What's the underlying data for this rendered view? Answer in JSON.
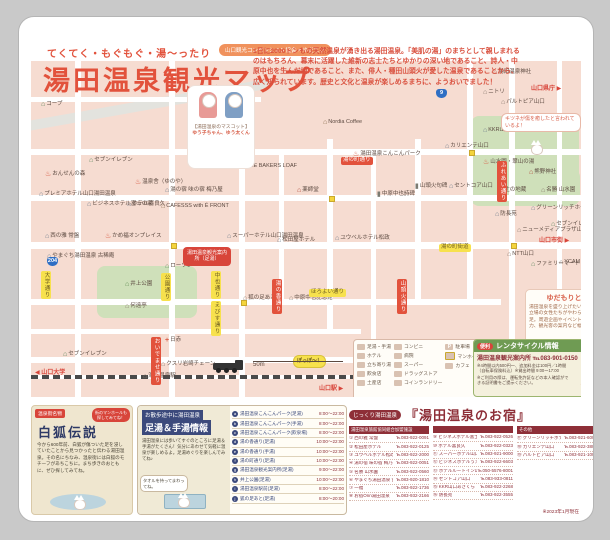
{
  "header": {
    "tagline": "てくてく・もぐもぐ・湯〜ったり",
    "title": "湯田温泉観光マップ",
    "assoc_badge": "山口観光コンベンション協会 × ゆだもり",
    "intro": "1日に2000トンもの天然温泉が湧き出る湯田温泉。「美肌の湯」のまちとして親しまれるのはもちろん、幕末に活躍した維新の志士たちとゆかりの深い地であること、詩人・中原中也を生んだ地であること、また、俳人・種田山頭火が愛した温泉であることから、広く知られています。歴史と文化と温泉が楽しめるまちに、ようおいでました！"
  },
  "mascot": {
    "caption_top": "【湯田温泉のマスコット】",
    "names": "ゆう子ちゃん、ゆう太くん"
  },
  "map": {
    "fox_bubble": "キツネが傷を癒したと言われているよ！",
    "train_bubble": "ぽっぽ〜！",
    "info_badge": "湯田温泉観光案内所（足湯）",
    "scale_label": "50m",
    "coffee_label": "Nordia Coffee",
    "shields": [
      {
        "num": "9",
        "x": 405,
        "y": 28
      },
      {
        "num": "204",
        "x": 16,
        "y": 196
      }
    ],
    "parks": [
      {
        "x": 440,
        "y": 55,
        "w": 108,
        "h": 90
      },
      {
        "x": 66,
        "y": 205,
        "w": 100,
        "h": 52
      },
      {
        "x": 505,
        "y": 108,
        "w": 44,
        "h": 36
      }
    ],
    "roads_h": [
      {
        "x": 0,
        "y": 88,
        "w": 550,
        "h": 6
      },
      {
        "x": 0,
        "y": 134,
        "w": 550,
        "h": 6
      },
      {
        "x": 0,
        "y": 181,
        "w": 550,
        "h": 7
      },
      {
        "x": 0,
        "y": 238,
        "w": 470,
        "h": 6
      },
      {
        "x": 0,
        "y": 268,
        "w": 330,
        "h": 5
      },
      {
        "x": 0,
        "y": 296,
        "w": 550,
        "h": 6
      },
      {
        "x": 0,
        "y": 36,
        "w": 230,
        "h": 5
      }
    ],
    "roads_v": [
      {
        "x": 44,
        "y": 0,
        "w": 6,
        "h": 336
      },
      {
        "x": 138,
        "y": 0,
        "w": 6,
        "h": 336
      },
      {
        "x": 208,
        "y": 78,
        "w": 6,
        "h": 258
      },
      {
        "x": 248,
        "y": 88,
        "w": 5,
        "h": 150
      },
      {
        "x": 296,
        "y": 78,
        "w": 6,
        "h": 190
      },
      {
        "x": 340,
        "y": 88,
        "w": 5,
        "h": 208
      },
      {
        "x": 384,
        "y": 78,
        "w": 6,
        "h": 160
      },
      {
        "x": 436,
        "y": 0,
        "w": 6,
        "h": 238
      },
      {
        "x": 478,
        "y": 0,
        "w": 6,
        "h": 296
      },
      {
        "x": 526,
        "y": 0,
        "w": 5,
        "h": 238
      }
    ],
    "manholes": [
      {
        "x": 140,
        "y": 182
      },
      {
        "x": 298,
        "y": 135
      },
      {
        "x": 438,
        "y": 89
      },
      {
        "x": 480,
        "y": 182
      },
      {
        "x": 210,
        "y": 239
      },
      {
        "x": 342,
        "y": 297
      }
    ],
    "road_labels": [
      {
        "label": "湯の町通り",
        "x": 310,
        "y": 96,
        "cls": "rlab-r"
      },
      {
        "label": "湯の町街道",
        "x": 408,
        "y": 183,
        "cls": "rlab-y"
      },
      {
        "label": "ほろよい通り",
        "x": 278,
        "y": 228,
        "cls": "rlab-y"
      },
      {
        "label": "公園通り",
        "x": 130,
        "y": 212,
        "cls": "rlab-y vert"
      },
      {
        "label": "中也通り",
        "x": 180,
        "y": 210,
        "cls": "rlab-y vert"
      },
      {
        "label": "えびす通り",
        "x": 180,
        "y": 240,
        "cls": "rlab-y vert"
      },
      {
        "label": "湯の香通り",
        "x": 241,
        "y": 218,
        "cls": "rlab-r vert"
      },
      {
        "label": "山頭火通り",
        "x": 366,
        "y": 218,
        "cls": "rlab-r vert"
      },
      {
        "label": "ふれあい通り",
        "x": 466,
        "y": 100,
        "cls": "rlab-r vert"
      },
      {
        "label": "おいでませ通り",
        "x": 120,
        "y": 276,
        "cls": "rlab-r vert"
      },
      {
        "label": "大学通り",
        "x": 10,
        "y": 210,
        "cls": "rlab-y vert"
      }
    ],
    "directions": [
      {
        "label": "山口県庁 ▶",
        "x": 500,
        "y": 22
      },
      {
        "label": "山口市街 ▶",
        "x": 508,
        "y": 174
      },
      {
        "label": "◀ 山口大学",
        "x": 4,
        "y": 306
      },
      {
        "label": "山口駅 ▶",
        "x": 288,
        "y": 322
      }
    ],
    "landmarks": [
      {
        "label": "湯田温泉神社",
        "x": 462,
        "y": 8,
        "icon": "ic-shrine"
      },
      {
        "label": "ニトリ",
        "x": 452,
        "y": 28,
        "icon": "ic-house"
      },
      {
        "label": "パルトピア山口",
        "x": 470,
        "y": 38,
        "icon": "ic-house"
      },
      {
        "label": "KKR山口あさくら",
        "x": 452,
        "y": 66,
        "icon": "ic-hotel"
      },
      {
        "label": "カリエンテ山口",
        "x": 414,
        "y": 82,
        "icon": "ic-hotel"
      },
      {
        "label": "山水園・翠山の湯",
        "x": 452,
        "y": 98,
        "icon": "ic-onsen"
      },
      {
        "label": "熊野神社",
        "x": 498,
        "y": 108,
        "icon": "ic-shrine"
      },
      {
        "label": "名勝 山水園",
        "x": 510,
        "y": 126,
        "icon": "ic-house"
      },
      {
        "label": "山頭火句碑",
        "x": 384,
        "y": 122,
        "icon": "ic-stone"
      },
      {
        "label": "セントコア山口",
        "x": 418,
        "y": 122,
        "icon": "ic-hotel"
      },
      {
        "label": "辻の地蔵",
        "x": 468,
        "y": 126,
        "icon": "ic-shrine"
      },
      {
        "label": "防長苑",
        "x": 464,
        "y": 150,
        "icon": "ic-hotel"
      },
      {
        "label": "グリーンリッチホテル",
        "x": 500,
        "y": 144,
        "icon": "ic-hotel"
      },
      {
        "label": "ニューメディアプラザ山口",
        "x": 486,
        "y": 166,
        "icon": "ic-house"
      },
      {
        "label": "NTT山口",
        "x": 476,
        "y": 190,
        "icon": "ic-house"
      },
      {
        "label": "セブンイレブン",
        "x": 520,
        "y": 160,
        "icon": "ic-conv"
      },
      {
        "label": "ファミリーマート",
        "x": 500,
        "y": 200,
        "icon": "ic-conv"
      },
      {
        "label": "YCAM",
        "x": 528,
        "y": 198,
        "icon": "ic-house"
      },
      {
        "label": "コープ",
        "x": 10,
        "y": 40,
        "icon": "ic-conv"
      },
      {
        "label": "セブンイレブン",
        "x": 58,
        "y": 96,
        "icon": "ic-conv"
      },
      {
        "label": "おんせんの森",
        "x": 14,
        "y": 110,
        "icon": "ic-onsen"
      },
      {
        "label": "プレミアホテル山口湯田温泉",
        "x": 8,
        "y": 130,
        "icon": "ic-hotel"
      },
      {
        "label": "ビジネスホテル富士の家",
        "x": 56,
        "y": 140,
        "icon": "ic-hotel"
      },
      {
        "label": "温泉舎（ゆのや）",
        "x": 104,
        "y": 118,
        "icon": "ic-onsen"
      },
      {
        "label": "ホテル喜良久",
        "x": 96,
        "y": 140,
        "icon": "ic-hotel"
      },
      {
        "label": "湯の宿 味の宿 梅乃屋",
        "x": 134,
        "y": 126,
        "icon": "ic-hotel"
      },
      {
        "label": "CAFESSS with É FRONT",
        "x": 130,
        "y": 142,
        "icon": "ic-cafe"
      },
      {
        "label": "西の雅 常盤",
        "x": 14,
        "y": 172,
        "icon": "ic-hotel"
      },
      {
        "label": "かめ福オンプレイス",
        "x": 74,
        "y": 172,
        "icon": "ic-onsen"
      },
      {
        "label": "やまぐち湯田温泉 古稀庵",
        "x": 16,
        "y": 192,
        "icon": "ic-hotel"
      },
      {
        "label": "ローソン",
        "x": 134,
        "y": 202,
        "icon": "ic-conv"
      },
      {
        "label": "THE BAKERS LOAF",
        "x": 210,
        "y": 102,
        "icon": "ic-cafe"
      },
      {
        "label": "湯田温泉こんこんパーク",
        "x": 322,
        "y": 90,
        "icon": "ic-foot"
      },
      {
        "label": "薬師堂",
        "x": 266,
        "y": 126,
        "icon": "ic-shrine"
      },
      {
        "label": "中原中也詩碑",
        "x": 346,
        "y": 130,
        "icon": "ic-stone"
      },
      {
        "label": "スーパーホテル山口湯田温泉",
        "x": 196,
        "y": 172,
        "icon": "ic-hotel"
      },
      {
        "label": "松田屋ホテル",
        "x": 246,
        "y": 176,
        "icon": "ic-hotel"
      },
      {
        "label": "ユウベルホテル松政",
        "x": 304,
        "y": 174,
        "icon": "ic-hotel"
      },
      {
        "label": "狐の足あと",
        "x": 212,
        "y": 234,
        "icon": "ic-house"
      },
      {
        "label": "中原中也記念館",
        "x": 258,
        "y": 234,
        "icon": "ic-house"
      },
      {
        "label": "井上公園",
        "x": 94,
        "y": 220,
        "icon": "ic-park"
      },
      {
        "label": "何遠亭",
        "x": 94,
        "y": 242,
        "icon": "ic-house"
      },
      {
        "label": "日赤",
        "x": 134,
        "y": 276,
        "icon": "ic-hosp"
      },
      {
        "label": "セブンイレブン",
        "x": 32,
        "y": 290,
        "icon": "ic-conv"
      },
      {
        "label": "クスリ岩崎チェーン",
        "x": 130,
        "y": 300,
        "icon": "ic-house"
      },
      {
        "label": "湯田温泉駅",
        "x": 112,
        "y": 312,
        "icon": "ic-house"
      }
    ]
  },
  "legend": {
    "col1": [
      "足湯・手湯",
      "ホテル",
      "立ち寄り湯",
      "飲食店",
      "土産店"
    ],
    "col2": [
      "コンビニ",
      "病院",
      "スーパー",
      "ドラッグストア",
      "コインランドリー"
    ],
    "col3": [
      "駐車場",
      "マンホール",
      "カフェ"
    ]
  },
  "yudamori": {
    "title": "ゆだもりとは…",
    "body": "湯田温泉を盛り上げたい、さまざまな立場の女性たちがやわらとなって発足。周遊企画やイベント開催への協力、観光客の案内など幅広く活動中！"
  },
  "rental": {
    "tag": "便利",
    "title": "レンタサイクル情報",
    "tel_line": "湯田温泉観光案内所 ℡083-901-0150",
    "note1": "※4時間以内500円〜、追加料金は100円／1時間（自転車保険料込）※貸出時間 9:00〜17:00",
    "note2": "※ご利用の際は、運転免許証などの本人確認ができる証明書をご提示ください。",
    "qr_caption": "山口市内の交通情報はこちらから！"
  },
  "fox_legend": {
    "ribbon": "温泉街名物",
    "title": "白狐伝説",
    "badge": "街のマンホールも探してみてね！",
    "body": "今から600年前、白狐が傷ついた足を浸していたことから見つかったと伝わる湯田温泉。その名にちなみ、温泉街には白狐のモチーフがあちこちに。まち歩きのおともに、ぜひ探してみてね。"
  },
  "footbath": {
    "title_top": "お散歩途中に湯田温泉",
    "title_main": "足湯＆手湯情報",
    "note": "湯田温泉には歩いてすぐのところに足湯＆手湯がたくさん！気分にあわせて気軽に温泉が楽しめるよ。足湯めぐりを楽しんでみてね♪",
    "bubble": "タオルを持ってまわってね。",
    "entries": [
      {
        "key": "a",
        "name": "湯田温泉こんこんパーク(足湯)",
        "time": "8:00〜22:00"
      },
      {
        "key": "b",
        "name": "湯田温泉こんこんパーク(手湯)",
        "time": "8:00〜22:00"
      },
      {
        "key": "c",
        "name": "湯田温泉こんこんパーク(飲泉場)",
        "time": "8:00〜22:00"
      },
      {
        "key": "d",
        "name": "湯の香通り(足湯)",
        "time": "10:00〜22:00"
      },
      {
        "key": "e",
        "name": "湯の香通り(手湯)",
        "time": "10:00〜22:00"
      },
      {
        "key": "f",
        "name": "湯の町通り(足湯)",
        "time": "10:00〜22:00"
      },
      {
        "key": "g",
        "name": "湯田温泉観光案内所(足湯)",
        "time": "9:00〜22:00"
      },
      {
        "key": "h",
        "name": "井上公園(足湯)",
        "time": "10:00〜22:00"
      },
      {
        "key": "i",
        "name": "湯田温泉駅前(足湯)",
        "time": "8:00〜22:00"
      },
      {
        "key": "j",
        "name": "狐の足あと(足湯)",
        "time": "8:00〜20:00"
      }
    ]
  },
  "lodging": {
    "tag": "じっくり湯田温泉",
    "title": "『湯田温泉のお宿』",
    "group1": "湯田温泉旅館協同組合加盟施設",
    "group2": "その他",
    "col1": [
      {
        "name": "① 西の雅 常盤",
        "tel": "℡083-922-0091"
      },
      {
        "name": "② 松田屋ホテル",
        "tel": "℡083-922-0125"
      },
      {
        "name": "③ ユウベルホテル松政",
        "tel": "℡083-922-2000"
      },
      {
        "name": "④ 湯の宿 味の宿 梅乃屋",
        "tel": "℡083-922-0051"
      },
      {
        "name": "⑤ 名勝 山水園",
        "tel": "℡083-922-0560"
      },
      {
        "name": "⑥ やまぐち湯田温泉 古稀庵",
        "tel": "℡083-920-1810"
      },
      {
        "name": "⑦ 一福",
        "tel": "℡083-922-1736"
      },
      {
        "name": "⑧ お宿Onn湯田温泉",
        "tel": "℡083-932-2166"
      }
    ],
    "col2": [
      {
        "name": "⑨ ビジネスホテル富士の家",
        "tel": "℡083-922-0526"
      },
      {
        "name": "⑩ ホテル喜良久",
        "tel": "℡083-922-0323"
      },
      {
        "name": "⑪ スーパーホテル山口湯田温泉",
        "tel": "℡083-921-9000"
      },
      {
        "name": "⑫ ビジネスホテルうえの",
        "tel": "℡083-922-6603"
      },
      {
        "name": "⑬ ホテルルートイン山口湯田温泉",
        "tel": "℡050-5576-8001"
      },
      {
        "name": "⑭ セントコア山口",
        "tel": "℡083-933-0811"
      },
      {
        "name": "⑮ KKR山口あさくら",
        "tel": "℡083-922-2268"
      },
      {
        "name": "⑯ 防長苑",
        "tel": "℡083-922-3555"
      }
    ],
    "col3": [
      {
        "name": "⑰ グリーンリッチホテル山口湯田温泉",
        "tel": "℡083-921-6000"
      },
      {
        "name": "⑱ カリエンテ山口",
        "tel": "℡083-922-3800"
      },
      {
        "name": "⑲ パルトピア山口",
        "tel": "℡083-921-1000"
      }
    ]
  },
  "footer_note": "※2023年1月現在"
}
